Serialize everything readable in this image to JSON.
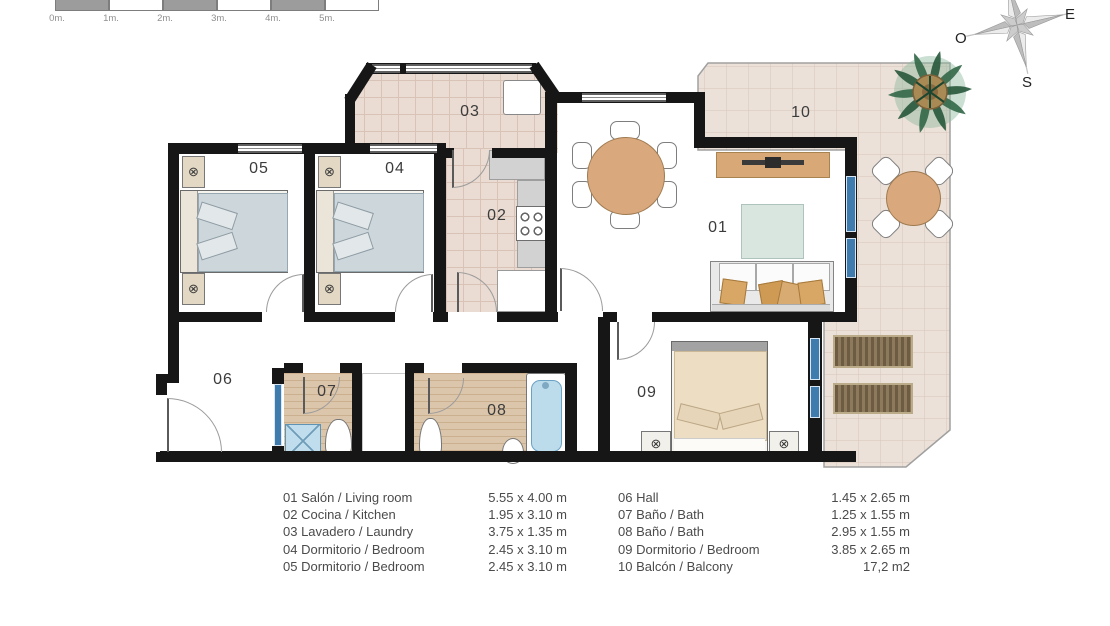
{
  "scale_bar": {
    "labels": [
      "0m.",
      "1m.",
      "2m.",
      "3m.",
      "4m.",
      "5m."
    ]
  },
  "compass": {
    "east": "E",
    "west": "O",
    "south": "S"
  },
  "plan_labels": {
    "r01": "01",
    "r02": "02",
    "r03": "03",
    "r04": "04",
    "r05": "05",
    "r06": "06",
    "r07": "07",
    "r08": "08",
    "r09": "09",
    "r10": "10"
  },
  "icons": {
    "ceiling_lamp": "⊗"
  },
  "legend": {
    "left": [
      {
        "name": "01 Salón / Living room",
        "dims": "5.55 x 4.00 m"
      },
      {
        "name": "02 Cocina / Kitchen",
        "dims": "1.95 x 3.10 m"
      },
      {
        "name": "03 Lavadero / Laundry",
        "dims": "3.75 x 1.35 m"
      },
      {
        "name": "04 Dormitorio / Bedroom",
        "dims": "2.45 x 3.10 m"
      },
      {
        "name": "05 Dormitorio / Bedroom",
        "dims": "2.45 x 3.10 m"
      }
    ],
    "right": [
      {
        "name": "06 Hall",
        "dims": "1.45 x 2.65 m"
      },
      {
        "name": "07 Baño / Bath",
        "dims": "1.25 x 1.55 m"
      },
      {
        "name": "08 Baño / Bath",
        "dims": "2.95 x 1.55 m"
      },
      {
        "name": "09 Dormitorio / Bedroom",
        "dims": "3.85 x 2.65 m"
      },
      {
        "name": "10 Balcón / Balcony",
        "dims": "17,2 m2"
      }
    ]
  },
  "colors": {
    "wall": "#161616",
    "tile_floor": "#eadcd2",
    "tile_grid": "#d9c3b6",
    "balcony_tile": "#ece1d9",
    "wood_floor": "#dcc6ab",
    "fixture_blue": "#bfdded",
    "window_blue": "#3f7cad",
    "furniture_tan": "#d9a87d",
    "compass_gray": "#c9c9c9"
  }
}
